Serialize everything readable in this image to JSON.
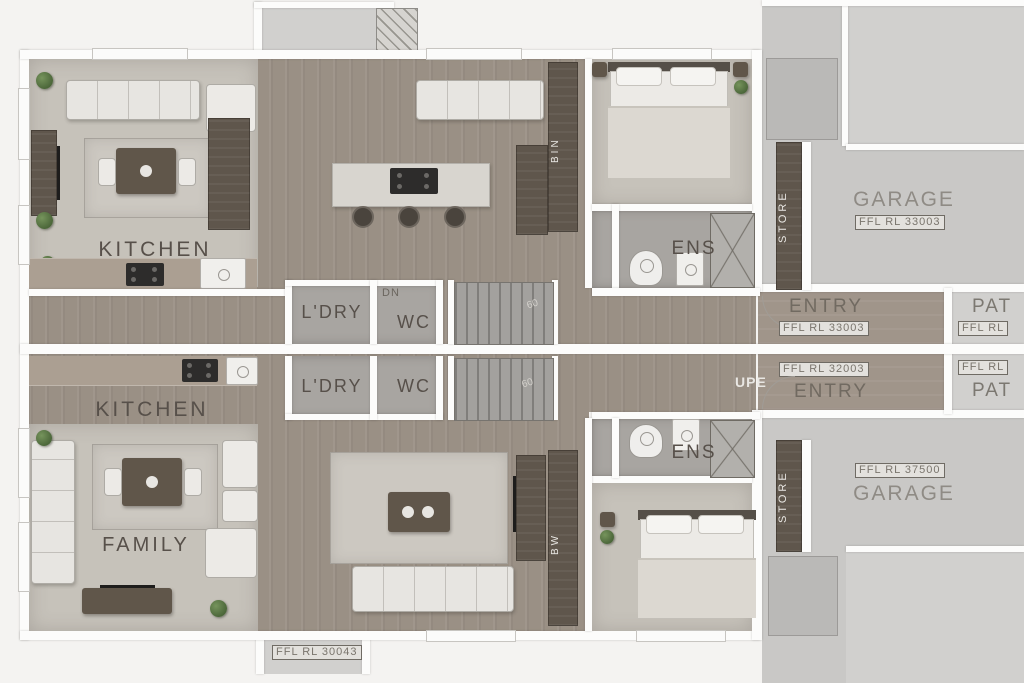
{
  "colors": {
    "background": "#f4f3f1",
    "wall": "#fcfcfb",
    "wood_floor": "#9a9085",
    "carpet": "#c6c2ba",
    "tile": "#a8a5a1",
    "garage_floor": "#c9c8c6",
    "dark_joinery": "#5f564c",
    "room_label_text": "#57504a",
    "garage_label_text": "#8f8b85",
    "plant_green": "#5b7746"
  },
  "unit_a": {
    "kitchen_label": "KITCHEN",
    "laundry_label": "L'DRY",
    "wc_label": "WC",
    "stair_label": "DN",
    "stair_mark": "60",
    "ensuite_label": "ENS",
    "bin_label": "BIN",
    "store_label": "STORE",
    "entry_label": "ENTRY",
    "entry_level": "FFL RL 33003",
    "garage_label": "GARAGE",
    "garage_level": "FFL RL 33003",
    "patio_label": "PAT",
    "patio_level": "FFL RL"
  },
  "unit_b": {
    "kitchen_label": "KITCHEN",
    "family_label": "FAMILY",
    "laundry_label": "L'DRY",
    "wc_label": "WC",
    "stair_label": "UPE",
    "stair_mark": "60",
    "ensuite_label": "ENS",
    "bin_label": "BW",
    "store_label": "STORE",
    "entry_label": "ENTRY",
    "entry_level": "FFL RL 32003",
    "garage_label": "GARAGE",
    "garage_level": "FFL RL 37500",
    "patio_label": "PAT",
    "patio_level": "FFL RL",
    "porch_level": "FFL RL 30043"
  }
}
